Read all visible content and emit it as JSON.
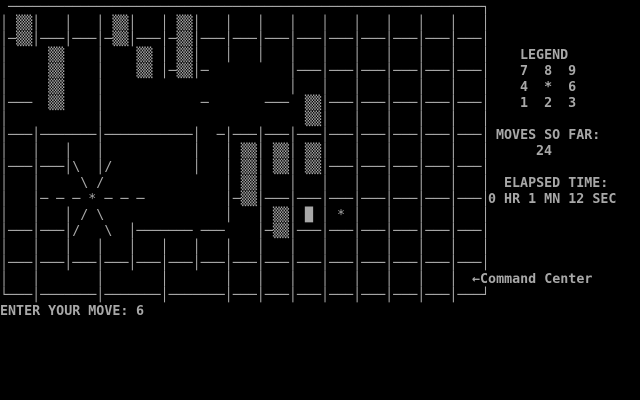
{
  "colors": {
    "bg": "#000000",
    "fg": "#a8a8a8"
  },
  "maze": {
    "rows": [
      " ───────────────────────────────────────────────────────────┐",
      "│ ▒▒│   │   │ ▒▒│   │ ▒▒│   │   │   │   │   │   │   │   │   │",
      "│─▒▒│───│───│─▒▒│───│─▒▒│───│───│───│───│───│───│───│───│───│",
      "│     ▒▒    │    ▒▒ │ ▒▒│   │   │   │   │   │   │   │   │   │",
      "│     ▒▒    │    ▒▒ │─▒▒│─          │───│───│───│───│───│───│",
      "│     ▒▒    │                       │   │   │   │   │   │   │",
      "│───  ▒▒    │            ─       ───  ▒▒│───│───│───│───│───│",
      "│           │                         ▒▒│   │   │   │   │   │",
      "│───│───────│───────────│  ─│───│───│───│───│───│───│───│───│",
      "│   │   │   │           │   │ ▒▒│ ▒▒│ ▒▒│   │   │   │   │   │",
      "│───│───│\\  │/          │   │ ▒▒│ ▒▒│ ▒▒│───│───│───│───│───│",
      "│   │     \\ /               │ ▒▒│   │   │   │   │   │   │   │",
      "│   │─ ─ ─ * ─ ─ ─          │─▒▒│───│───│───│───│───│───│───│",
      "│   │   │ / \\               │   │ ▒▒│ █ │ * │   │   │   │   │",
      "│───│───│/   \\  │─────── ───    │─▒▒│───│───│───│───│───│───│",
      "│   │   │   │   │   │   │   │   │   │   │   │   │   │   │   │",
      "│───│───│───│───│───│───│───│───│───│───│───│───│───│───│───│",
      "│   │       │       │       │   │   │   │   │   │   │   │    ",
      "└───│───────│───────│───────│───│───│───│───│───│───│───│───┘"
    ]
  },
  "panel": {
    "legend_title": "LEGEND",
    "legend_rows": [
      "7  8  9",
      "4  *  6",
      "1  2  3"
    ],
    "moves_label": "MOVES SO FAR:",
    "moves_value": "24",
    "elapsed_label": "ELAPSED TIME:",
    "elapsed_value": "0 HR 1 MN 12 SEC",
    "command_arrow": "←",
    "command_label": "Command Center"
  },
  "prompt": {
    "label": "ENTER YOUR MOVE:",
    "value": "6"
  }
}
